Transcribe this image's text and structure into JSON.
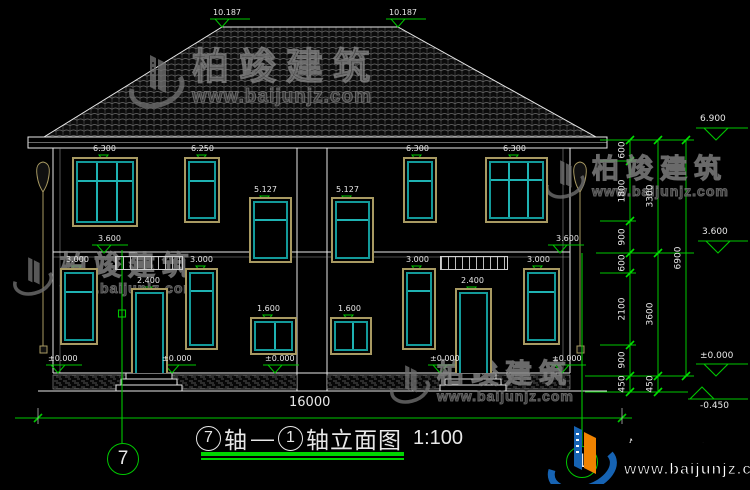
{
  "brand": {
    "name": "柏竣建筑",
    "url": "www.baijunjz.com"
  },
  "title": {
    "bubble_left": "7",
    "axis_left": "轴",
    "dash": "—",
    "bubble_right": "1",
    "text": "轴立面图",
    "scale": "1:100"
  },
  "axis_bubbles": {
    "left": "7",
    "right": "1"
  },
  "roof_levels": {
    "left": "10.187",
    "right": "10.187"
  },
  "floor2_windows": [
    {
      "label": "6.300"
    },
    {
      "label": "6.250"
    },
    {
      "label": "5.127"
    },
    {
      "label": "5.127"
    },
    {
      "label": "6.300"
    },
    {
      "label": "6.300"
    }
  ],
  "floor1_openings": [
    {
      "label": "3.000"
    },
    {
      "label": "2.400"
    },
    {
      "label": "3.000"
    },
    {
      "label": "1.600"
    },
    {
      "label": "1.600"
    },
    {
      "label": "3.000"
    },
    {
      "label": "2.400"
    },
    {
      "label": "3.000"
    }
  ],
  "inner_levels": {
    "left_floor2": "3.600",
    "right_floor2": "3.600",
    "ground": [
      "±0.000",
      "±0.000",
      "±0.000",
      "±0.000",
      "±0.000"
    ]
  },
  "dims": {
    "total_width": "16000",
    "right_chain_inner": [
      "600",
      "1800",
      "900",
      "600",
      "2100",
      "900",
      "450"
    ],
    "right_chain_mid": [
      "3300",
      "3600",
      "450"
    ],
    "right_chain_outer": [
      "6900"
    ],
    "right_levels": {
      "eave": "6.900",
      "floor2": "3.600",
      "ground": "±0.000",
      "site": "-0.450"
    }
  }
}
